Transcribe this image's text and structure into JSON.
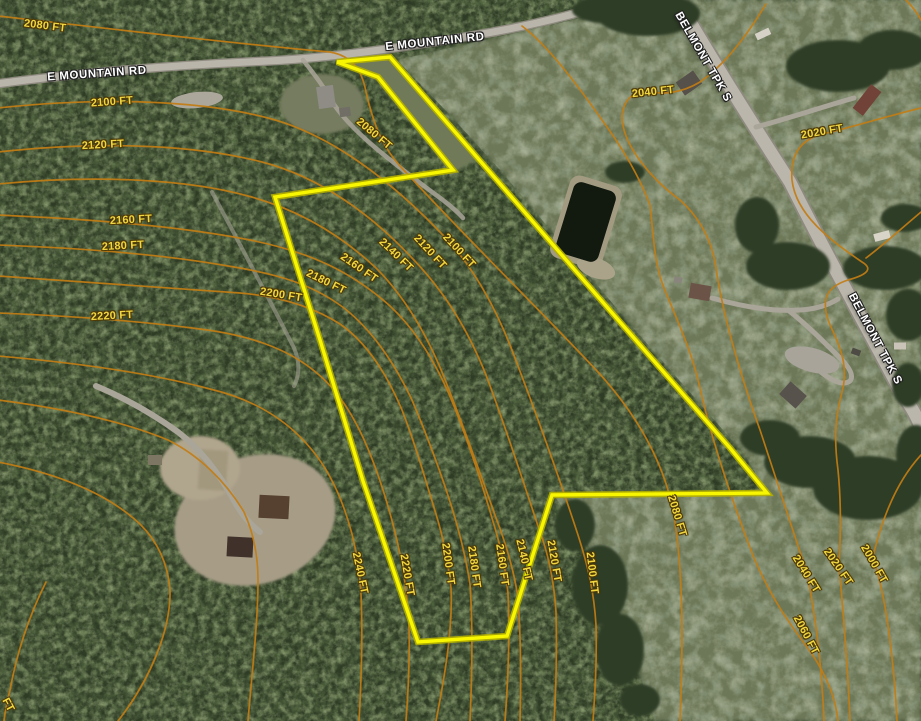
{
  "map": {
    "size": {
      "w": 921,
      "h": 721
    },
    "colors": {
      "parcel_line": "#f8f600",
      "parcel_casing": "#b5b000",
      "contour_line": "#c27d14",
      "contour_label_text": "#f0d741",
      "road_label_text": "#ffffff",
      "forest_base": "#2e3b25",
      "field_base": "#6d7858",
      "road_fill": "#b9b5aa",
      "pond_fill": "#12190f"
    },
    "parcel": {
      "points": "337,62 390,57 620,322 730,448 767,493 552,495 507,636 418,642 363,481 320,340 275,197 453,170 378,77"
    },
    "roads": [
      {
        "name": "E MOUNTAIN RD",
        "labels": [
          {
            "x": 97,
            "y": 74,
            "rot": -4
          },
          {
            "x": 435,
            "y": 42,
            "rot": -6
          }
        ]
      },
      {
        "name": "BELMONT TPK S",
        "labels": [
          {
            "x": 703,
            "y": 57,
            "rot": 60
          },
          {
            "x": 875,
            "y": 339,
            "rot": 62
          }
        ]
      }
    ],
    "contours": [
      {
        "elevation": 2000,
        "unit": "FT",
        "path": "M 921 455 C 898 480 884 515 876 545 C 872 557 873 562 876 568 C 886 600 894 660 897 721",
        "labels": [
          {
            "x": 874,
            "y": 564,
            "rot": 60
          }
        ]
      },
      {
        "elevation": 2020,
        "unit": "FT",
        "path": "M 921 108 C 880 118 850 128 822 134 C 800 140 790 155 792 180 C 796 215 830 240 862 262 C 872 268 870 274 848 280 C 826 287 820 300 830 325 C 843 352 848 370 842 392 C 835 418 834 440 838 470 C 842 510 840 545 839 565 C 843 610 848 670 850 721",
        "labels": [
          {
            "x": 822,
            "y": 132,
            "rot": -10
          },
          {
            "x": 838,
            "y": 567,
            "rot": 55
          }
        ]
      },
      {
        "elevation": 2040,
        "unit": "FT",
        "path": "M 766 4 C 748 34 726 64 700 82 C 680 94 662 94 652 92 C 634 89 624 99 622 116 C 622 144 650 178 680 200 C 700 218 712 240 716 268 C 722 310 738 368 760 430 C 776 478 792 528 800 552 C 804 562 806 570 808 578 C 816 620 822 670 824 721",
        "labels": [
          {
            "x": 653,
            "y": 92,
            "rot": -6
          },
          {
            "x": 806,
            "y": 574,
            "rot": 58
          }
        ]
      },
      {
        "elevation": 2060,
        "unit": "FT",
        "path": "M 522 26 C 546 44 574 80 602 120 C 624 150 640 178 650 205 C 654 240 654 262 664 288 C 678 322 692 352 700 388 C 712 442 736 512 754 558 C 772 600 790 624 812 654 C 828 678 836 700 838 721",
        "labels": [
          {
            "x": 806,
            "y": 635,
            "rot": 62
          }
        ]
      },
      {
        "elevation": 2080,
        "unit": "FT",
        "path": "M -2 16 C 120 30 240 44 330 52 C 352 56 362 70 366 92 C 372 118 380 144 400 166 C 468 240 540 310 598 372 C 640 418 662 462 672 505 C 682 555 684 625 680 721",
        "labels": [
          {
            "x": 45,
            "y": 26,
            "rot": 7
          },
          {
            "x": 374,
            "y": 134,
            "rot": 40
          },
          {
            "x": 677,
            "y": 516,
            "rot": 73
          }
        ]
      },
      {
        "elevation": 2100,
        "unit": "FT",
        "path": "M -2 108 C 100 97 200 100 268 118 C 330 134 390 180 440 232 C 470 262 492 300 510 345 C 535 410 560 480 578 535 C 588 566 594 592 596 625 C 597 660 595 692 593 721",
        "labels": [
          {
            "x": 112,
            "y": 102,
            "rot": -4
          },
          {
            "x": 459,
            "y": 251,
            "rot": 47
          },
          {
            "x": 592,
            "y": 573,
            "rot": 83
          }
        ]
      },
      {
        "elevation": 2120,
        "unit": "FT",
        "path": "M -2 152 C 110 140 200 146 262 162 C 320 177 372 215 412 258 C 445 292 468 330 486 375 C 506 428 524 484 538 526 C 548 552 554 580 556 612 C 557 652 556 690 554 721",
        "labels": [
          {
            "x": 103,
            "y": 145,
            "rot": -3
          },
          {
            "x": 430,
            "y": 252,
            "rot": 47
          },
          {
            "x": 554,
            "y": 561,
            "rot": 80
          }
        ]
      },
      {
        "elevation": 2140,
        "unit": "FT",
        "path": "M -2 184 C 100 174 190 180 248 196 C 300 210 342 236 376 268 C 406 298 428 336 446 382 C 464 428 482 478 496 518 C 506 544 514 570 518 598 C 521 640 521 684 520 721",
        "labels": [
          {
            "x": 396,
            "y": 255,
            "rot": 44
          },
          {
            "x": 524,
            "y": 560,
            "rot": 77
          }
        ]
      },
      {
        "elevation": 2160,
        "unit": "FT",
        "path": "M -2 215 C 90 219 180 226 250 240 C 310 252 352 272 390 306 C 418 332 438 366 454 406 C 470 446 482 484 492 518 C 500 544 506 568 508 594 C 510 637 508 682 505 721",
        "labels": [
          {
            "x": 131,
            "y": 220,
            "rot": -3
          },
          {
            "x": 359,
            "y": 268,
            "rot": 35
          },
          {
            "x": 502,
            "y": 565,
            "rot": 82
          }
        ]
      },
      {
        "elevation": 2180,
        "unit": "FT",
        "path": "M -2 245 C 80 248 160 254 228 266 C 278 274 312 284 344 308 C 372 330 394 362 412 400 C 428 438 442 476 452 508 C 460 534 466 558 470 584 C 473 626 472 676 470 721",
        "labels": [
          {
            "x": 123,
            "y": 246,
            "rot": -3
          },
          {
            "x": 326,
            "y": 282,
            "rot": 26
          },
          {
            "x": 474,
            "y": 567,
            "rot": 82
          }
        ]
      },
      {
        "elevation": 2200,
        "unit": "FT",
        "path": "M -2 276 C 90 282 170 288 240 293 C 276 296 310 305 340 324 C 366 342 386 372 402 410 C 416 446 426 482 436 514 C 444 540 448 562 451 588 C 453 630 444 680 436 721",
        "labels": [
          {
            "x": 281,
            "y": 295,
            "rot": 9
          },
          {
            "x": 448,
            "y": 564,
            "rot": 82
          }
        ]
      },
      {
        "elevation": 2220,
        "unit": "FT",
        "path": "M -2 313 C 70 316 140 321 200 329 C 248 335 288 348 318 374 C 342 394 360 426 374 464 C 386 496 394 526 400 554 C 405 578 408 602 409 628 C 410 663 408 694 406 721",
        "labels": [
          {
            "x": 112,
            "y": 316,
            "rot": -3
          },
          {
            "x": 407,
            "y": 575,
            "rot": 80
          }
        ]
      },
      {
        "elevation": 2240,
        "unit": "FT",
        "path": "M -2 356 C 80 363 150 373 210 389 C 252 399 286 418 312 450 C 332 474 344 504 352 534 C 357 554 360 574 361 594 C 363 640 361 686 359 721",
        "labels": [
          {
            "x": 360,
            "y": 573,
            "rot": 78
          }
        ]
      },
      {
        "elevation": 2260,
        "unit": "FT",
        "path": "M 46 582 C 30 614 17 652 10 690 C 7 702 5 712 4 721",
        "labels": []
      }
    ],
    "extra_contours": [
      "M -2 400 C 60 408 120 420 168 440 C 200 456 226 482 244 512 C 254 534 258 556 258 580 C 258 622 252 672 248 721",
      "M -2 462 C 60 474 108 494 140 524 C 158 542 168 564 170 590 C 171 630 150 680 118 721",
      "M 921 212 C 902 228 882 246 866 258",
      "M 904 -2 C 912 6 918 14 921 20"
    ],
    "partial_labels": [
      {
        "text": "FT",
        "x": 8,
        "y": 705,
        "rot": 62
      }
    ],
    "buildings": [
      {
        "x": 326,
        "y": 97,
        "w": 17,
        "h": 22,
        "rot": -8,
        "color": "#8f8c85"
      },
      {
        "x": 345,
        "y": 112,
        "w": 11,
        "h": 9,
        "rot": -8,
        "color": "#716e66"
      },
      {
        "x": 763,
        "y": 34,
        "w": 15,
        "h": 7,
        "rot": -25,
        "color": "#d6d2c7"
      },
      {
        "x": 689,
        "y": 83,
        "w": 16,
        "h": 21,
        "rot": 55,
        "color": "#55504a"
      },
      {
        "x": 867,
        "y": 100,
        "w": 13,
        "h": 30,
        "rot": 38,
        "color": "#714238"
      },
      {
        "x": 882,
        "y": 236,
        "w": 16,
        "h": 8,
        "rot": -15,
        "color": "#d8d4c8"
      },
      {
        "x": 678,
        "y": 280,
        "w": 8,
        "h": 6,
        "rot": 10,
        "color": "#8a857c"
      },
      {
        "x": 700,
        "y": 292,
        "w": 21,
        "h": 15,
        "rot": 10,
        "color": "#6b5348"
      },
      {
        "x": 793,
        "y": 395,
        "w": 22,
        "h": 17,
        "rot": 42,
        "color": "#57524c"
      },
      {
        "x": 900,
        "y": 346,
        "w": 12,
        "h": 7,
        "rot": 0,
        "color": "#c9c4b7"
      },
      {
        "x": 856,
        "y": 352,
        "w": 9,
        "h": 6,
        "rot": 20,
        "color": "#4e4a44"
      },
      {
        "x": 240,
        "y": 547,
        "w": 26,
        "h": 20,
        "rot": 3,
        "color": "#40322a"
      },
      {
        "x": 274,
        "y": 507,
        "w": 30,
        "h": 23,
        "rot": 3,
        "color": "#564130"
      },
      {
        "x": 155,
        "y": 460,
        "w": 14,
        "h": 10,
        "rot": 0,
        "color": "#7d7663"
      }
    ]
  }
}
